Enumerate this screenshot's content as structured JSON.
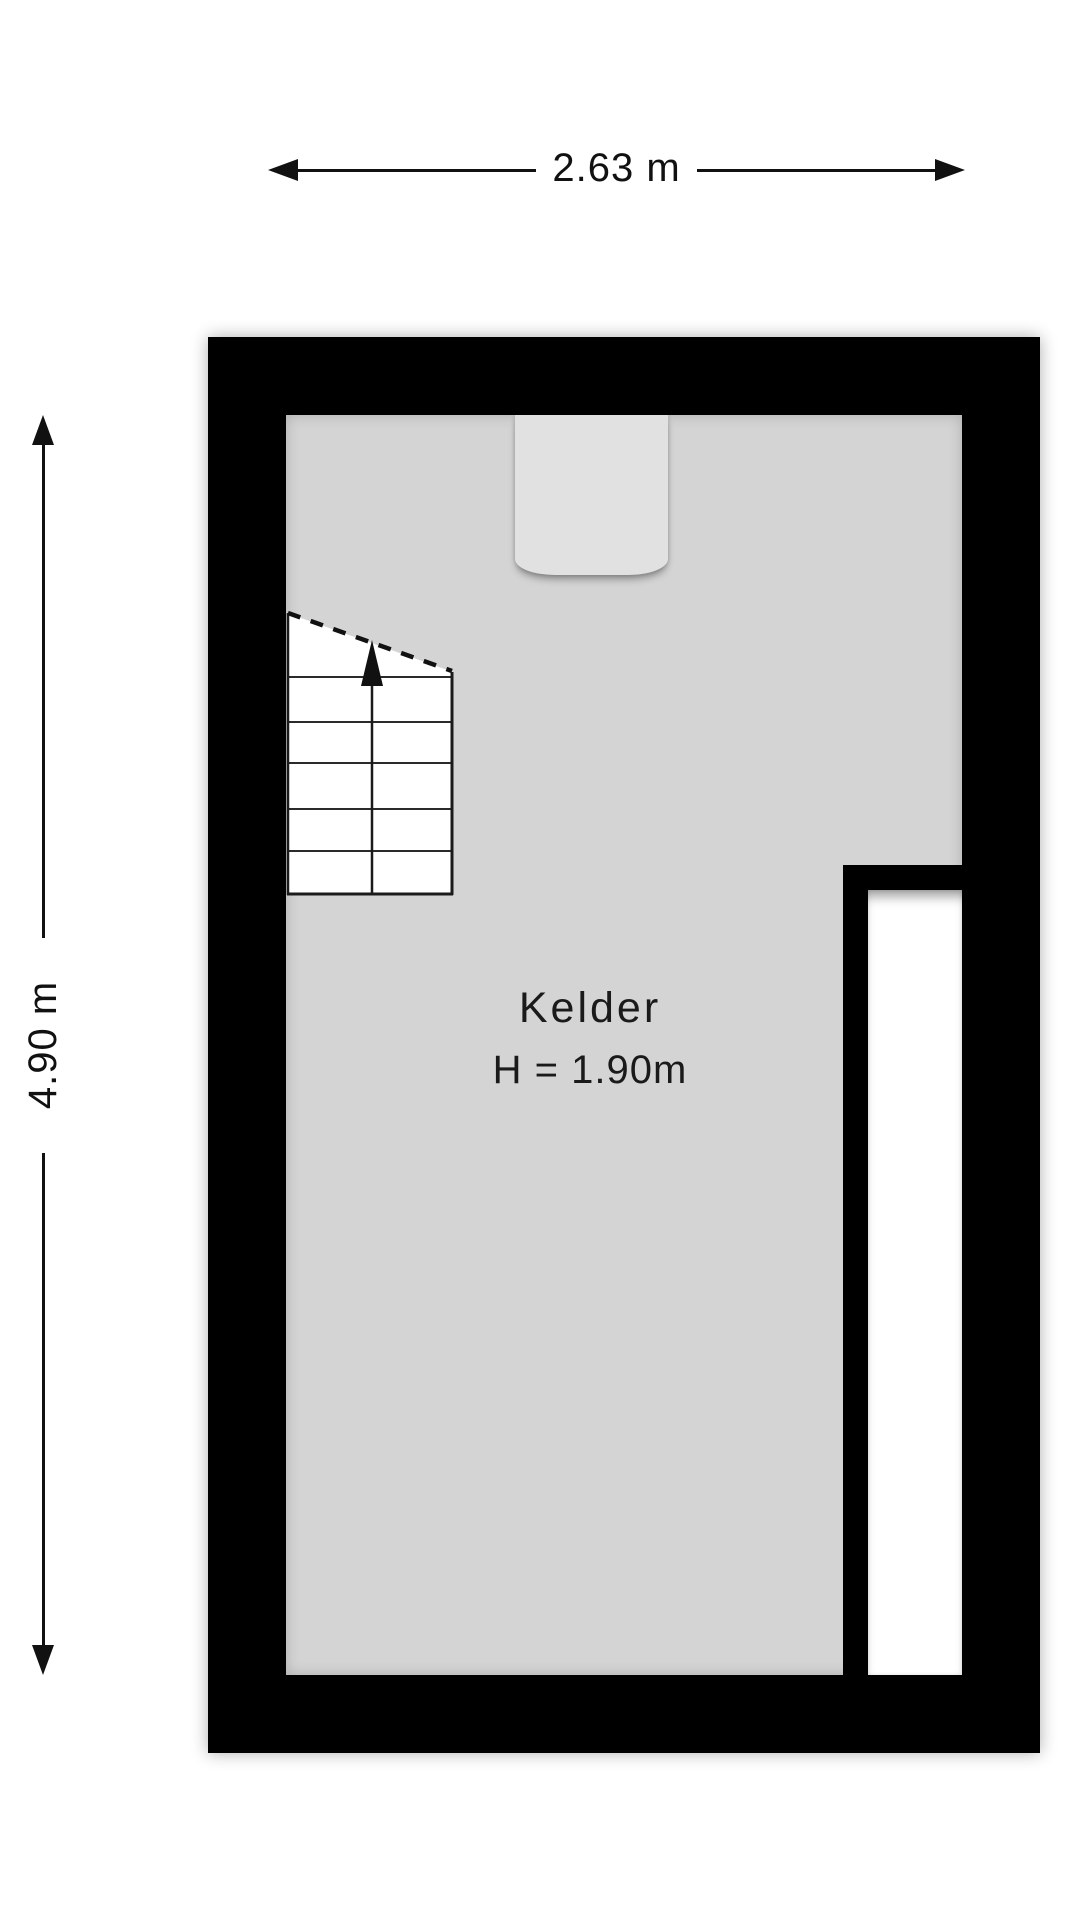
{
  "floorplan": {
    "room": {
      "name": "Kelder",
      "ceiling_height": "H = 1.90m"
    },
    "dimensions": {
      "width_label": "2.63 m",
      "height_label": "4.90 m"
    },
    "colors": {
      "wall": "#000000",
      "floor": "#d4d4d4",
      "door_niche": "#e1e1e1",
      "void": "#ffffff",
      "line": "#111111"
    },
    "icons": {
      "stairs_up_arrow": "triangle-up",
      "dimension_arrowheads": "triangle"
    }
  }
}
